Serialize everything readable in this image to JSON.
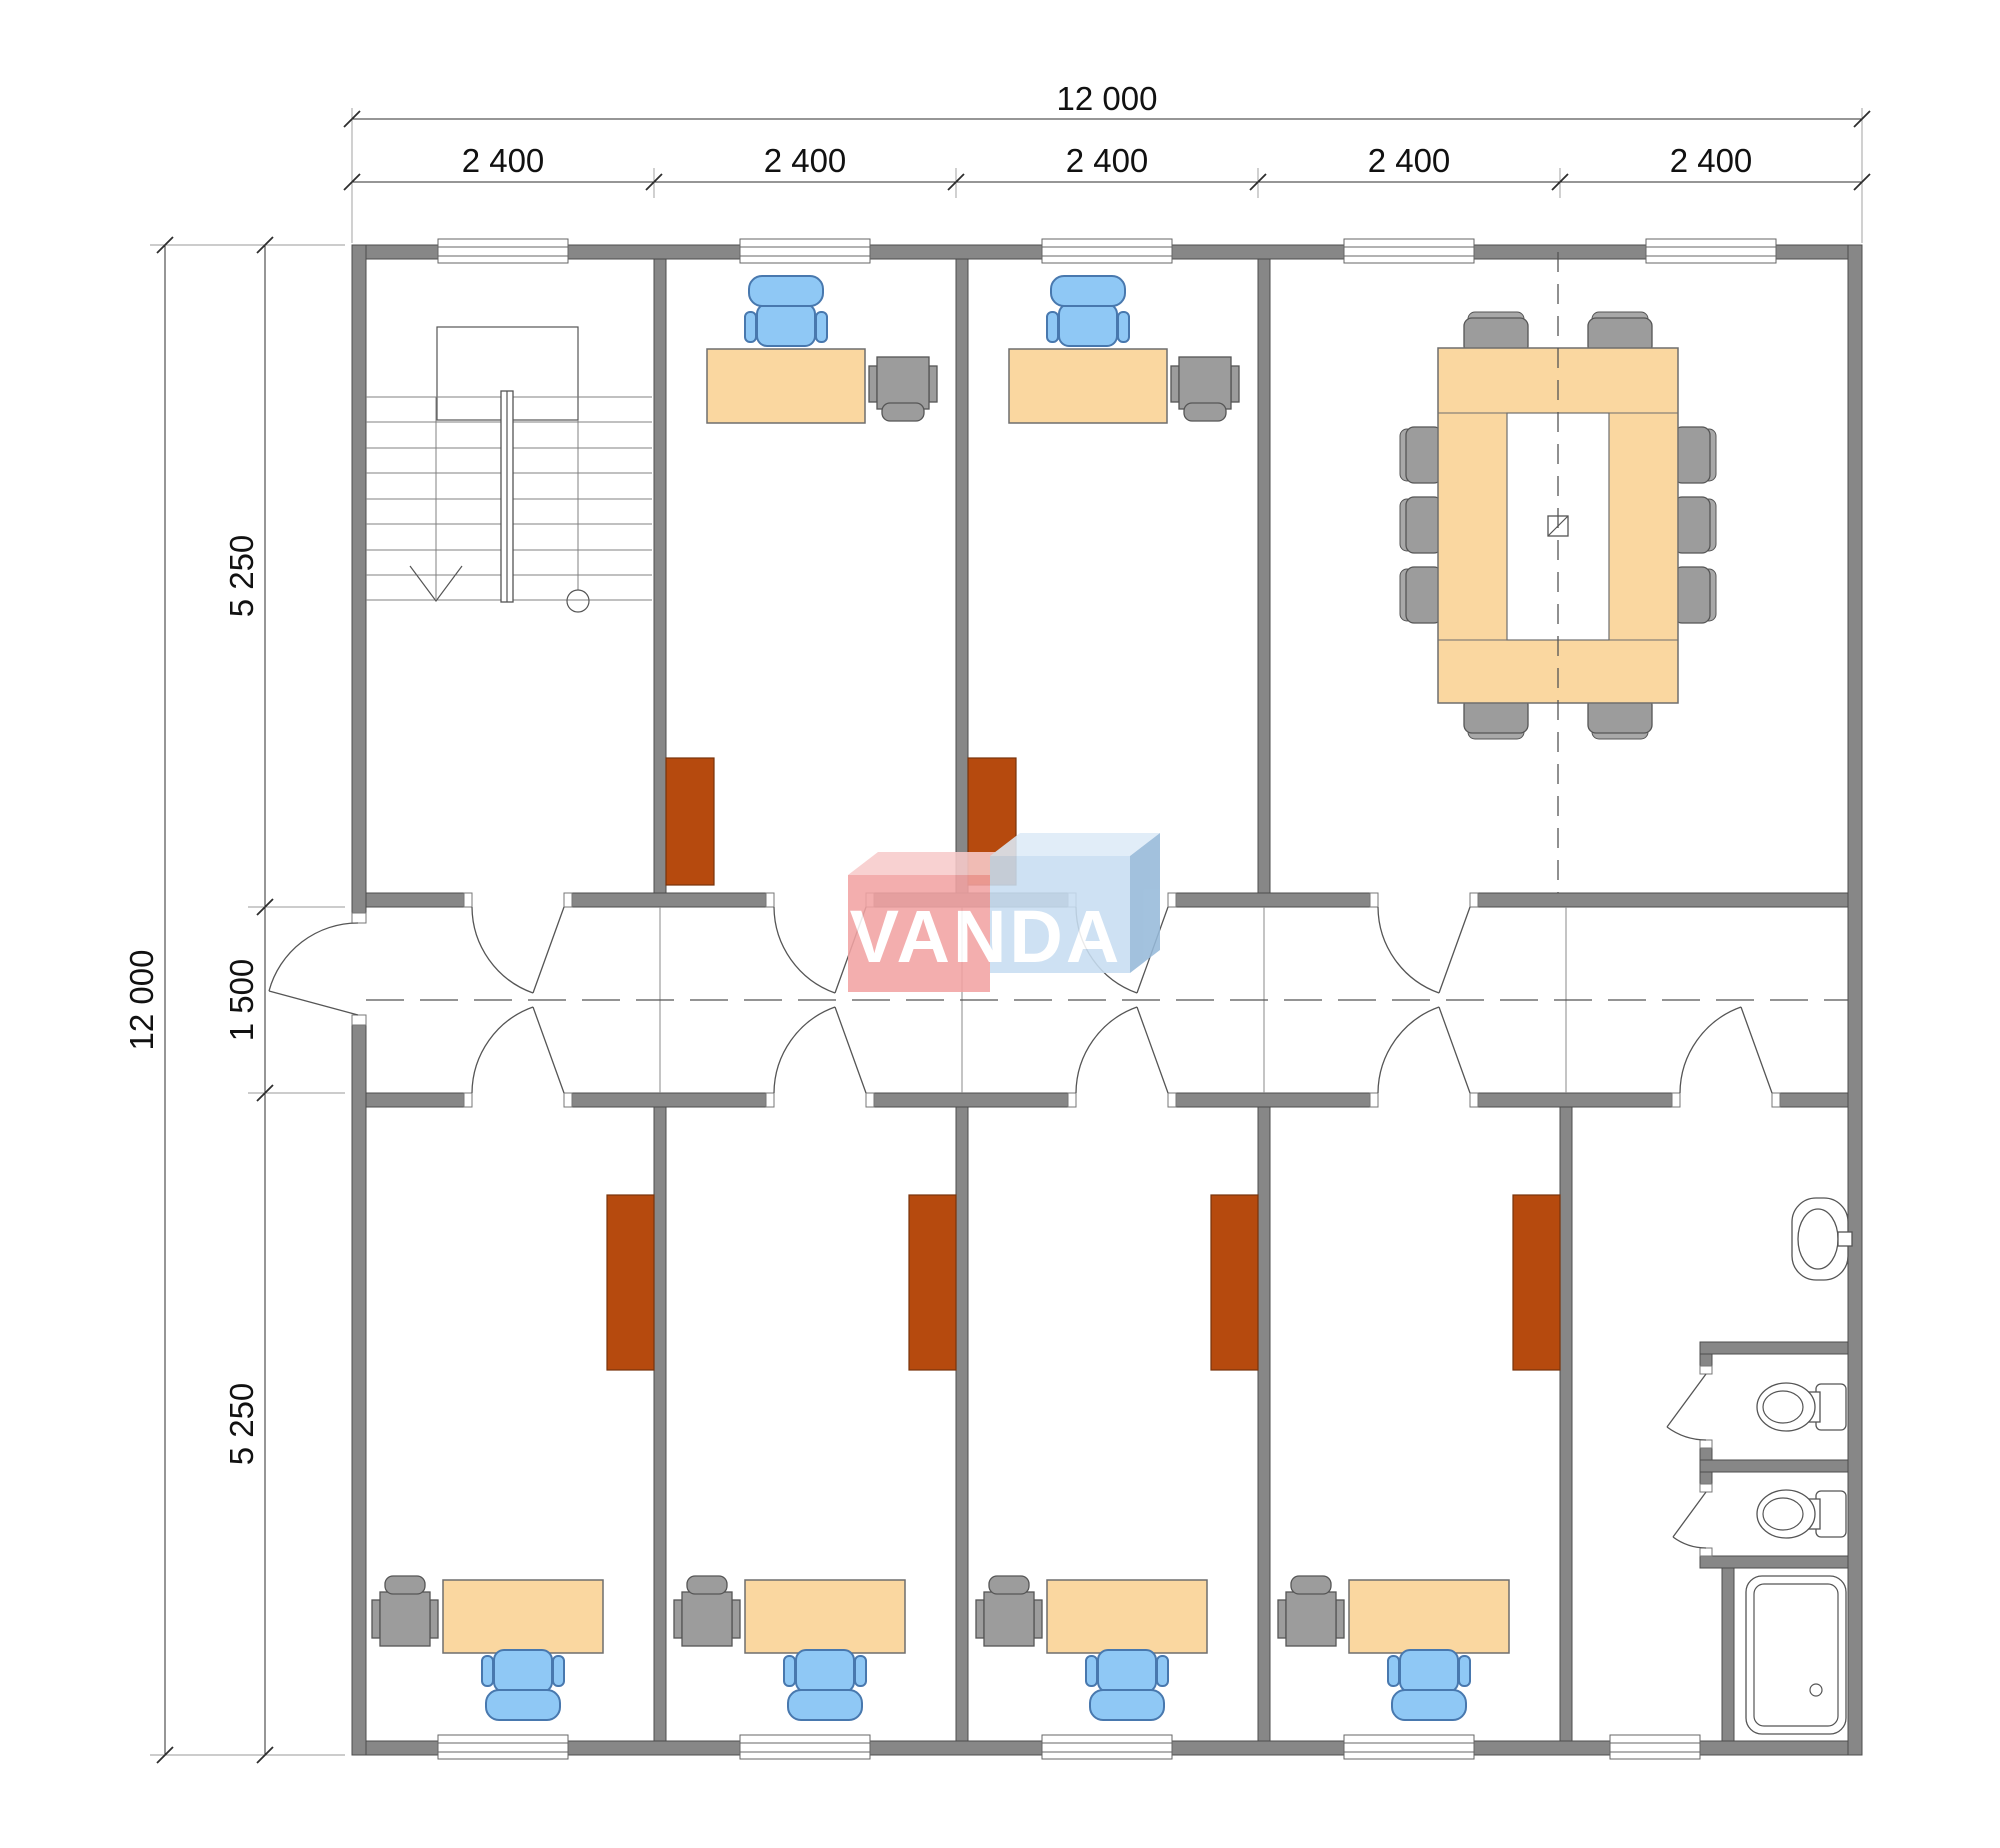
{
  "dimensions": {
    "overall_width_label": "12 000",
    "overall_height_label": "12 000",
    "top_bay_labels": [
      "2 400",
      "2 400",
      "2 400",
      "2 400",
      "2 400"
    ],
    "left_segment_labels": [
      "5 250",
      "1 500",
      "5 250"
    ]
  },
  "logo": {
    "text": "VANDA"
  },
  "colors": {
    "wall": "#878787",
    "desk": "#FAD7A0",
    "chair": "#8FC8F5",
    "cabinet": "#B64A0E",
    "furniture_gray": "#9C9C9C",
    "logo_red": "#F2A3A3",
    "logo_red_top": "#F8CBCB",
    "logo_blue": "#C8DEF2",
    "logo_blue_top": "#DDEBF8",
    "logo_blue_side": "#96B9D9"
  }
}
